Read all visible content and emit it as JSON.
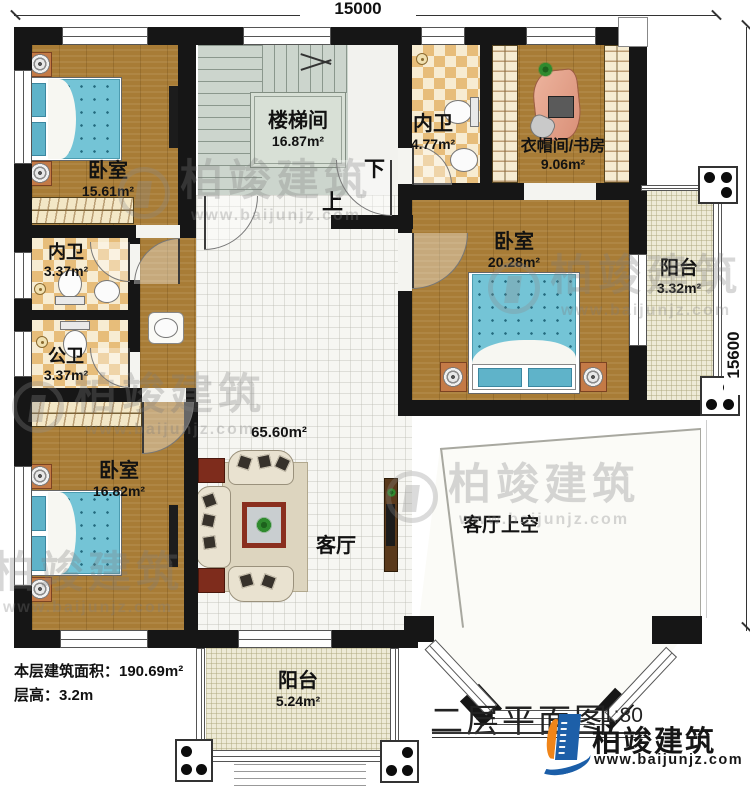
{
  "dimensions": {
    "top": "15000",
    "right": "15600"
  },
  "stairs": {
    "name": "楼梯间",
    "area": "16.87m²",
    "up": "上",
    "down": "下"
  },
  "rooms": {
    "bedroom_tl": {
      "name": "卧室",
      "area": "15.61m²"
    },
    "bath_tl": {
      "name": "内卫",
      "area": "3.37m²"
    },
    "bath_public": {
      "name": "公卫",
      "area": "3.37m²"
    },
    "bedroom_bl": {
      "name": "卧室",
      "area": "16.82m²"
    },
    "bath_top": {
      "name": "内卫",
      "area": "4.77m²"
    },
    "cloak_study": {
      "name": "衣帽间/书房",
      "area": "9.06m²"
    },
    "bedroom_r": {
      "name": "卧室",
      "area": "20.28m²"
    },
    "balcony_r": {
      "name": "阳台",
      "area": "3.32m²"
    },
    "living": {
      "name": "客厅",
      "area": "65.60m²"
    },
    "living_void": {
      "name": "客厅上空"
    },
    "balcony_b": {
      "name": "阳台",
      "area": "5.24m²"
    }
  },
  "footer": {
    "area_line": "本层建筑面积：190.69m²",
    "height_line": "层高：3.2m"
  },
  "title_block": {
    "title": "二层平面图",
    "scale": "1:80"
  },
  "logo": {
    "name": "柏竣建筑",
    "url": "www.baijunjz.com"
  },
  "watermark": {
    "name": "柏竣建筑",
    "url": "www.baijunjz.com"
  },
  "palette": {
    "wall": "#161616",
    "wood": "#a87c36",
    "checker": "#e7bd7a",
    "bed": "#74c4d6",
    "logo_blue": "#1d5fa8",
    "logo_orange": "#f08519"
  }
}
